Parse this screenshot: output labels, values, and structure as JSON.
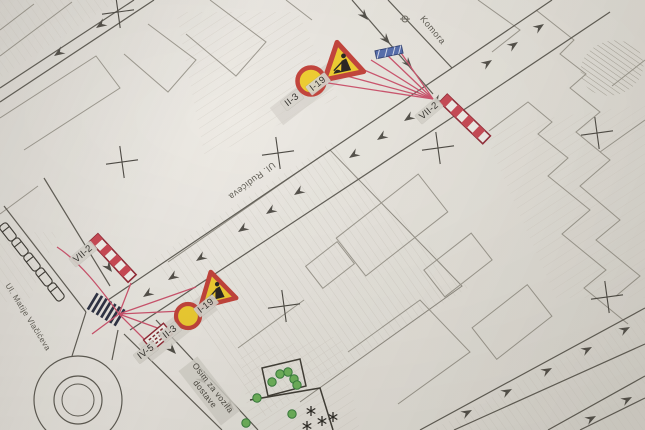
{
  "plan": {
    "streets": {
      "rudiceva": "Ul. Rudićeva",
      "matije_vlacica": "Ul. Matije Vlačićeva",
      "komora": "Komora"
    },
    "signs": {
      "top_triangle": "I-19",
      "top_circle": "II-3",
      "top_barrier": "VII-2",
      "bottom_triangle": "I-19",
      "bottom_circle": "II-3",
      "bottom_panel": "IV-5",
      "left_barrier": "VII-2"
    },
    "note": {
      "line1": "Osim za vozila",
      "line2": "dostave"
    }
  },
  "colors": {
    "sign_red": "#c23b33",
    "sign_yellow": "#f0cd28",
    "barrier_red": "#c9414e",
    "overlay_line": "#cc4d68",
    "fence_blue": "#4f68ac",
    "paper": "#eae7e1"
  }
}
